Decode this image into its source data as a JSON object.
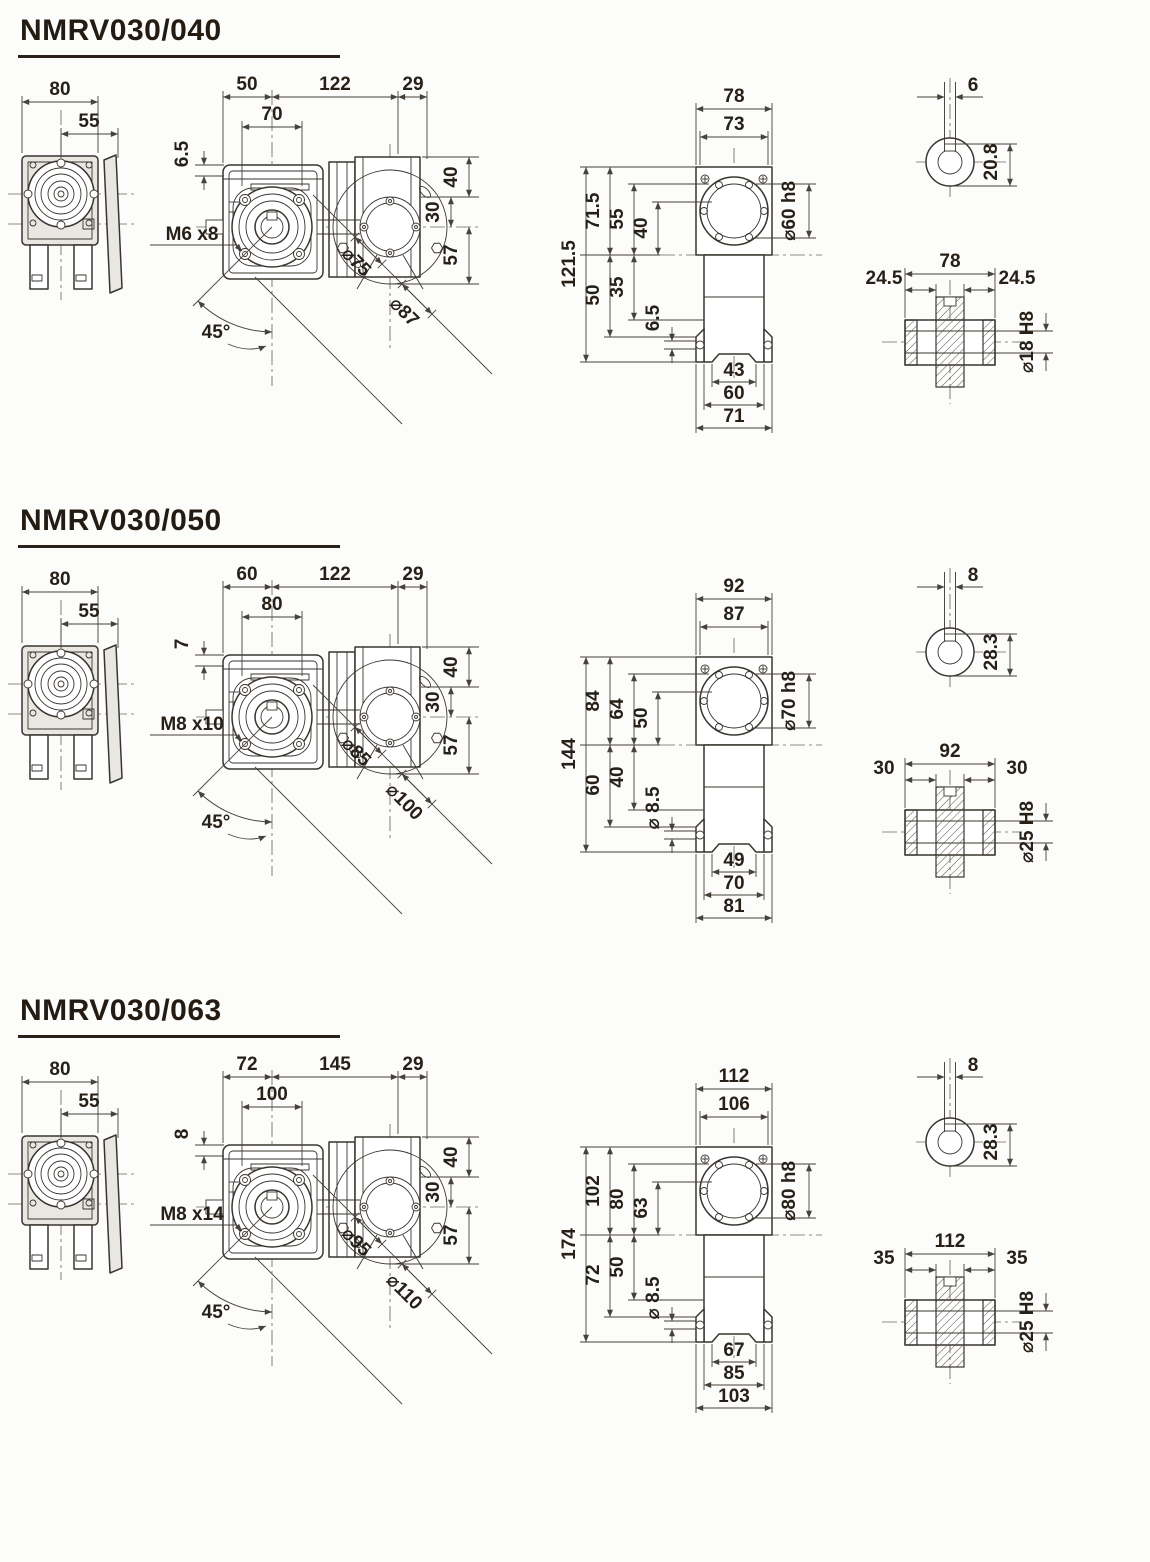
{
  "page": {
    "background": "#fcfcfa",
    "line_color": "#3a352f",
    "text_color": "#262019"
  },
  "sections": [
    {
      "title": "NMRV030/040",
      "side_view": {
        "dim_outer": "80",
        "dim_inner": "55"
      },
      "front_view": {
        "dim_left_top": "50",
        "dim_mid_top": "122",
        "dim_right_top": "29",
        "dim_inner_width": "70",
        "dim_offset": "6.5",
        "thread_label": "M6 x8",
        "angle_label": "45°",
        "dim_circle_inner": "⌀75",
        "dim_circle_outer": "⌀87",
        "dim_v_top": "40",
        "dim_v_mid": "30",
        "dim_v_bot": "57"
      },
      "elevation": {
        "dim_top_outer": "78",
        "dim_top_inner": "73",
        "dim_bore": "⌀60 h8",
        "dim_total_h": "121.5",
        "dim_h2_top": "71.5",
        "dim_h2_bot": "50",
        "dim_h3_top": "55",
        "dim_h3_bot": "35",
        "dim_h4_top": "40",
        "dim_bottom_small": "6.5",
        "dim_bot_inner": "43",
        "dim_bot_mid": "60",
        "dim_bot_outer": "71"
      },
      "input_shaft": {
        "dim_key_w": "6",
        "dim_key_h": "20.8"
      },
      "output_shaft": {
        "dim_total": "78",
        "dim_left": "24.5",
        "dim_right": "24.5",
        "dim_bore": "⌀18 H8"
      }
    },
    {
      "title": "NMRV030/050",
      "side_view": {
        "dim_outer": "80",
        "dim_inner": "55"
      },
      "front_view": {
        "dim_left_top": "60",
        "dim_mid_top": "122",
        "dim_right_top": "29",
        "dim_inner_width": "80",
        "dim_offset": "7",
        "thread_label": "M8 x10",
        "angle_label": "45°",
        "dim_circle_inner": "⌀85",
        "dim_circle_outer": "⌀100",
        "dim_v_top": "40",
        "dim_v_mid": "30",
        "dim_v_bot": "57"
      },
      "elevation": {
        "dim_top_outer": "92",
        "dim_top_inner": "87",
        "dim_bore": "⌀70 h8",
        "dim_total_h": "144",
        "dim_h2_top": "84",
        "dim_h2_bot": "60",
        "dim_h3_top": "64",
        "dim_h3_bot": "40",
        "dim_h4_top": "50",
        "dim_bottom_small": "⌀ 8.5",
        "dim_bot_inner": "49",
        "dim_bot_mid": "70",
        "dim_bot_outer": "81"
      },
      "input_shaft": {
        "dim_key_w": "8",
        "dim_key_h": "28.3"
      },
      "output_shaft": {
        "dim_total": "92",
        "dim_left": "30",
        "dim_right": "30",
        "dim_bore": "⌀25 H8"
      }
    },
    {
      "title": "NMRV030/063",
      "side_view": {
        "dim_outer": "80",
        "dim_inner": "55"
      },
      "front_view": {
        "dim_left_top": "72",
        "dim_mid_top": "145",
        "dim_right_top": "29",
        "dim_inner_width": "100",
        "dim_offset": "8",
        "thread_label": "M8 x14",
        "angle_label": "45°",
        "dim_circle_inner": "⌀95",
        "dim_circle_outer": "⌀110",
        "dim_v_top": "40",
        "dim_v_mid": "30",
        "dim_v_bot": "57"
      },
      "elevation": {
        "dim_top_outer": "112",
        "dim_top_inner": "106",
        "dim_bore": "⌀80 h8",
        "dim_total_h": "174",
        "dim_h2_top": "102",
        "dim_h2_bot": "72",
        "dim_h3_top": "80",
        "dim_h3_bot": "50",
        "dim_h4_top": "63",
        "dim_bottom_small": "⌀ 8.5",
        "dim_bot_inner": "67",
        "dim_bot_mid": "85",
        "dim_bot_outer": "103"
      },
      "input_shaft": {
        "dim_key_w": "8",
        "dim_key_h": "28.3"
      },
      "output_shaft": {
        "dim_total": "112",
        "dim_left": "35",
        "dim_right": "35",
        "dim_bore": "⌀25 H8"
      }
    }
  ]
}
